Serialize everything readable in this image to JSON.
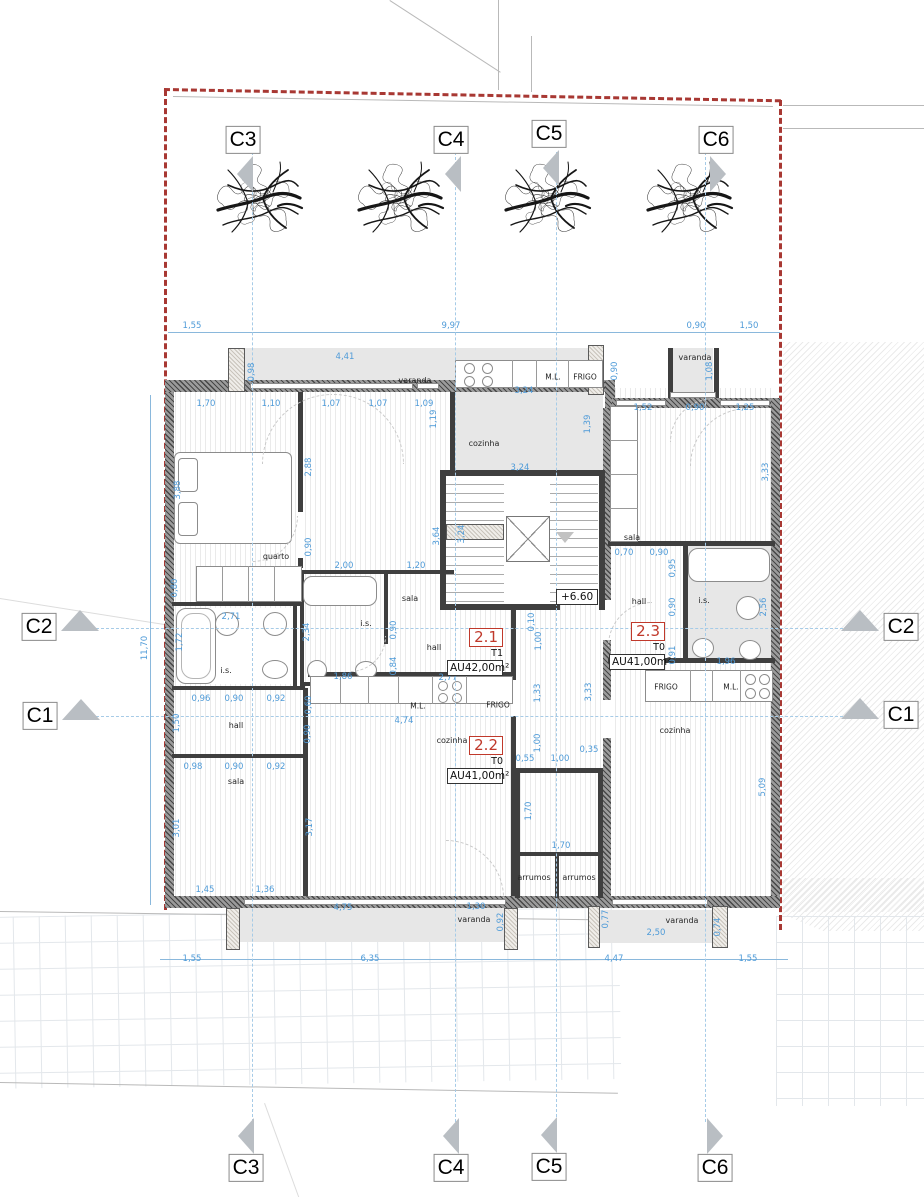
{
  "palette": {
    "dim_blue": "#4f9bd8",
    "boundary_red": "#a83833",
    "marker_gray": "#b9bec3",
    "unit_red": "#c0392b"
  },
  "level_marker": {
    "text": "+6.60"
  },
  "trees": [
    {
      "x": 258
    },
    {
      "x": 399
    },
    {
      "x": 546
    },
    {
      "x": 688
    }
  ],
  "markers": [
    {
      "id": "C3",
      "edge": "top",
      "x": 243,
      "y": 140,
      "dir": "left"
    },
    {
      "id": "C4",
      "edge": "top",
      "x": 451,
      "y": 140,
      "dir": "left"
    },
    {
      "id": "C5",
      "edge": "top",
      "x": 549,
      "y": 134,
      "dir": "left"
    },
    {
      "id": "C6",
      "edge": "top",
      "x": 716,
      "y": 140,
      "dir": "right"
    },
    {
      "id": "C2",
      "edge": "left",
      "x": 39,
      "y": 627,
      "dir": "up"
    },
    {
      "id": "C1",
      "edge": "left",
      "x": 40,
      "y": 716,
      "dir": "up"
    },
    {
      "id": "C2",
      "edge": "right",
      "x": 901,
      "y": 627,
      "dir": "up"
    },
    {
      "id": "C1",
      "edge": "right",
      "x": 901,
      "y": 715,
      "dir": "up"
    },
    {
      "id": "C3",
      "edge": "bottom",
      "x": 246,
      "y": 1168,
      "dir": "left"
    },
    {
      "id": "C4",
      "edge": "bottom",
      "x": 451,
      "y": 1168,
      "dir": "left"
    },
    {
      "id": "C5",
      "edge": "bottom",
      "x": 549,
      "y": 1167,
      "dir": "left"
    },
    {
      "id": "C6",
      "edge": "bottom",
      "x": 715,
      "y": 1168,
      "dir": "right"
    }
  ],
  "section_lines": {
    "vertical_x": [
      252,
      455,
      556,
      705
    ],
    "vertical_top": 152,
    "vertical_bottom": 1122,
    "horizontal_y": [
      628,
      716
    ],
    "horizontal_left": 96,
    "horizontal_right": 848
  },
  "units": [
    {
      "num": "2.1",
      "type": "T1",
      "area": "AU42,00m²",
      "x": 447,
      "y": 627
    },
    {
      "num": "2.2",
      "type": "T0",
      "area": "AU41,00m²",
      "x": 447,
      "y": 735
    },
    {
      "num": "2.3",
      "type": "T0",
      "area": "AU41,00m²",
      "x": 609,
      "y": 621
    }
  ],
  "rooms": [
    {
      "label": "varanda",
      "area": "4,30 m2",
      "x": 415,
      "y": 381
    },
    {
      "label": "varanda",
      "area": "1,00 m2",
      "x": 695,
      "y": 358
    },
    {
      "label": "cozinha",
      "area": "7,40 m2",
      "x": 484,
      "y": 444
    },
    {
      "label": "quarto",
      "area": "12,60 m2",
      "x": 276,
      "y": 557
    },
    {
      "label": "sala",
      "area": "13,50 m2",
      "x": 410,
      "y": 599
    },
    {
      "label": "sala",
      "area": "12,20 m2",
      "x": 632,
      "y": 538
    },
    {
      "label": "i.s.",
      "area": "4,40 m2",
      "x": 366,
      "y": 624
    },
    {
      "label": "i.s.",
      "area": "4,70 m2",
      "x": 226,
      "y": 671
    },
    {
      "label": "i.s.",
      "area": "5,00 m2",
      "x": 704,
      "y": 601
    },
    {
      "label": "hall",
      "area": "5,00 m2",
      "x": 639,
      "y": 602
    },
    {
      "label": "hall",
      "area": "4,20 m2",
      "x": 434,
      "y": 648
    },
    {
      "label": "hall",
      "area": "4,20 m2",
      "x": 236,
      "y": 726
    },
    {
      "label": "cozinha",
      "area": "22,70 m2",
      "x": 452,
      "y": 741
    },
    {
      "label": "cozinha",
      "area": "18,50 m2",
      "x": 675,
      "y": 731
    },
    {
      "label": "sala",
      "area": "10,00 m2",
      "x": 236,
      "y": 782
    },
    {
      "label": "arrumos",
      "area": "0,80 m2",
      "x": 534,
      "y": 878
    },
    {
      "label": "arrumos",
      "area": "0,80 m2",
      "x": 579,
      "y": 878
    },
    {
      "label": "varanda",
      "area": "5,80 m2",
      "x": 474,
      "y": 920
    },
    {
      "label": "varanda",
      "area": "2,20 m2",
      "x": 682,
      "y": 921
    }
  ],
  "appliances": [
    {
      "t": "M.L.",
      "x": 553,
      "y": 377
    },
    {
      "t": "FRIGO",
      "x": 585,
      "y": 377
    },
    {
      "t": "M.L.",
      "x": 418,
      "y": 706
    },
    {
      "t": "FRIGO",
      "x": 498,
      "y": 705
    },
    {
      "t": "FRIGO",
      "x": 666,
      "y": 687
    },
    {
      "t": "M.L.",
      "x": 731,
      "y": 687
    }
  ],
  "dims": [
    {
      "t": "1,55",
      "x": 192,
      "y": 326
    },
    {
      "t": "9,97",
      "x": 451,
      "y": 326
    },
    {
      "t": "0,90",
      "x": 696,
      "y": 326
    },
    {
      "t": "1,50",
      "x": 749,
      "y": 326
    },
    {
      "t": "4,41",
      "x": 345,
      "y": 357
    },
    {
      "t": "0,98",
      "x": 252,
      "y": 372,
      "r": 1
    },
    {
      "t": "3,24",
      "x": 524,
      "y": 391
    },
    {
      "t": "0,90",
      "x": 615,
      "y": 371,
      "r": 1
    },
    {
      "t": "1,08",
      "x": 710,
      "y": 371,
      "r": 1
    },
    {
      "t": "1,70",
      "x": 206,
      "y": 404
    },
    {
      "t": "1,10",
      "x": 271,
      "y": 404
    },
    {
      "t": "1,07",
      "x": 331,
      "y": 404
    },
    {
      "t": "1,07",
      "x": 378,
      "y": 404
    },
    {
      "t": "1,09",
      "x": 424,
      "y": 404
    },
    {
      "t": "1,19",
      "x": 434,
      "y": 419,
      "r": 1
    },
    {
      "t": "1,52",
      "x": 643,
      "y": 408
    },
    {
      "t": "0,90",
      "x": 695,
      "y": 408
    },
    {
      "t": "1,25",
      "x": 745,
      "y": 408
    },
    {
      "t": "1,39",
      "x": 588,
      "y": 424,
      "r": 1
    },
    {
      "t": "3,88",
      "x": 178,
      "y": 490,
      "r": 1
    },
    {
      "t": "2,88",
      "x": 309,
      "y": 467,
      "r": 1
    },
    {
      "t": "3,24",
      "x": 520,
      "y": 468
    },
    {
      "t": "3,33",
      "x": 766,
      "y": 472,
      "r": 1
    },
    {
      "t": "3,64",
      "x": 437,
      "y": 536,
      "r": 1
    },
    {
      "t": "3,24",
      "x": 462,
      "y": 534,
      "r": 1
    },
    {
      "t": "0,90",
      "x": 309,
      "y": 547,
      "r": 1
    },
    {
      "t": "2,00",
      "x": 344,
      "y": 566
    },
    {
      "t": "1,20",
      "x": 416,
      "y": 566
    },
    {
      "t": "0,80",
      "x": 175,
      "y": 588,
      "r": 1
    },
    {
      "t": "2,71",
      "x": 231,
      "y": 617
    },
    {
      "t": "0,10",
      "x": 532,
      "y": 622,
      "r": 1
    },
    {
      "t": "1,72",
      "x": 180,
      "y": 642,
      "r": 1
    },
    {
      "t": "2,34",
      "x": 307,
      "y": 632,
      "r": 1
    },
    {
      "t": "1,00",
      "x": 539,
      "y": 641,
      "r": 1
    },
    {
      "t": "0,90",
      "x": 394,
      "y": 630,
      "r": 1
    },
    {
      "t": "0,84",
      "x": 394,
      "y": 666,
      "r": 1
    },
    {
      "t": "0,70",
      "x": 624,
      "y": 553
    },
    {
      "t": "0,90",
      "x": 659,
      "y": 553
    },
    {
      "t": "0,95",
      "x": 673,
      "y": 568,
      "r": 1
    },
    {
      "t": "0,90",
      "x": 673,
      "y": 607,
      "r": 1
    },
    {
      "t": "2,56",
      "x": 764,
      "y": 607,
      "r": 1
    },
    {
      "t": "0,91",
      "x": 673,
      "y": 655,
      "r": 1
    },
    {
      "t": "1,96",
      "x": 726,
      "y": 662
    },
    {
      "t": "1,86",
      "x": 343,
      "y": 677
    },
    {
      "t": "2,77",
      "x": 448,
      "y": 678
    },
    {
      "t": "0,96",
      "x": 201,
      "y": 699
    },
    {
      "t": "0,90",
      "x": 234,
      "y": 699
    },
    {
      "t": "0,92",
      "x": 276,
      "y": 699
    },
    {
      "t": "0,60",
      "x": 309,
      "y": 705,
      "r": 1
    },
    {
      "t": "0,90",
      "x": 308,
      "y": 734,
      "r": 1
    },
    {
      "t": "1,33",
      "x": 538,
      "y": 693,
      "r": 1
    },
    {
      "t": "3,33",
      "x": 589,
      "y": 692,
      "r": 1
    },
    {
      "t": "4,74",
      "x": 404,
      "y": 721
    },
    {
      "t": "11,70",
      "x": 145,
      "y": 648,
      "r": 1
    },
    {
      "t": "1,50",
      "x": 177,
      "y": 723,
      "r": 1
    },
    {
      "t": "0,98",
      "x": 193,
      "y": 767
    },
    {
      "t": "0,90",
      "x": 234,
      "y": 767
    },
    {
      "t": "0,92",
      "x": 276,
      "y": 767
    },
    {
      "t": "1,00",
      "x": 538,
      "y": 743,
      "r": 1
    },
    {
      "t": "0,55",
      "x": 525,
      "y": 759
    },
    {
      "t": "1,00",
      "x": 560,
      "y": 759
    },
    {
      "t": "0,35",
      "x": 589,
      "y": 750
    },
    {
      "t": "3,01",
      "x": 177,
      "y": 828,
      "r": 1
    },
    {
      "t": "3,17",
      "x": 310,
      "y": 827,
      "r": 1
    },
    {
      "t": "5,09",
      "x": 763,
      "y": 787,
      "r": 1
    },
    {
      "t": "1,70",
      "x": 529,
      "y": 811,
      "r": 1
    },
    {
      "t": "1,70",
      "x": 561,
      "y": 846
    },
    {
      "t": "1,45",
      "x": 205,
      "y": 890
    },
    {
      "t": "1,36",
      "x": 265,
      "y": 890
    },
    {
      "t": "4,75",
      "x": 343,
      "y": 908
    },
    {
      "t": "1,30",
      "x": 476,
      "y": 907
    },
    {
      "t": "0,92",
      "x": 501,
      "y": 922,
      "r": 1
    },
    {
      "t": "0,77",
      "x": 606,
      "y": 919,
      "r": 1
    },
    {
      "t": "2,50",
      "x": 656,
      "y": 933
    },
    {
      "t": "0,74",
      "x": 718,
      "y": 927,
      "r": 1
    },
    {
      "t": "1,55",
      "x": 192,
      "y": 959
    },
    {
      "t": "6,35",
      "x": 370,
      "y": 959
    },
    {
      "t": "4,47",
      "x": 614,
      "y": 959
    },
    {
      "t": "1,55",
      "x": 748,
      "y": 959
    }
  ]
}
